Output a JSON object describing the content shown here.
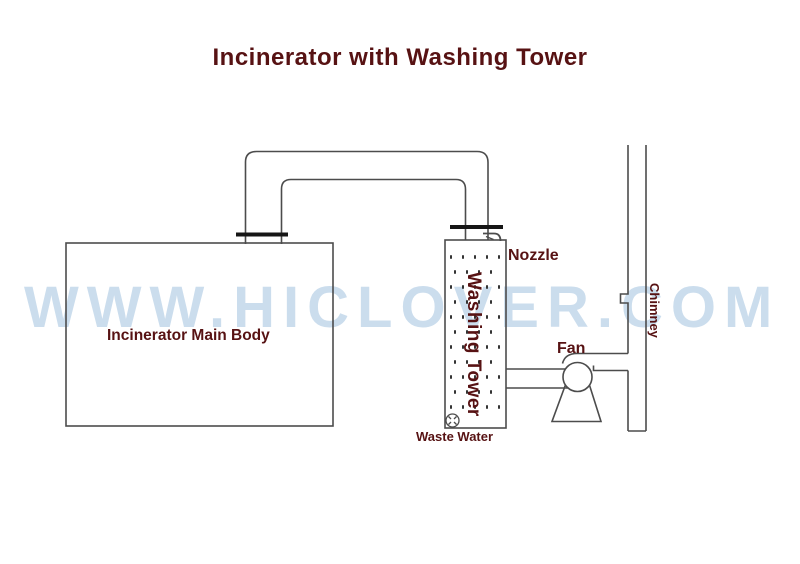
{
  "title": "Incinerator with Washing Tower",
  "watermark": "WWW.HICLOVER.COM",
  "colors": {
    "accent_text": "#571213",
    "line": "#4c4c4c",
    "flange": "#161616",
    "watermark": "#cbdded",
    "background": "#ffffff"
  },
  "labels": {
    "incinerator_main_body": "Incinerator Main Body",
    "washing_tower": "Washing Tower",
    "nozzle": "Nozzle",
    "fan": "Fan",
    "chimney": "Chimney",
    "waste_water": "Waste Water"
  }
}
